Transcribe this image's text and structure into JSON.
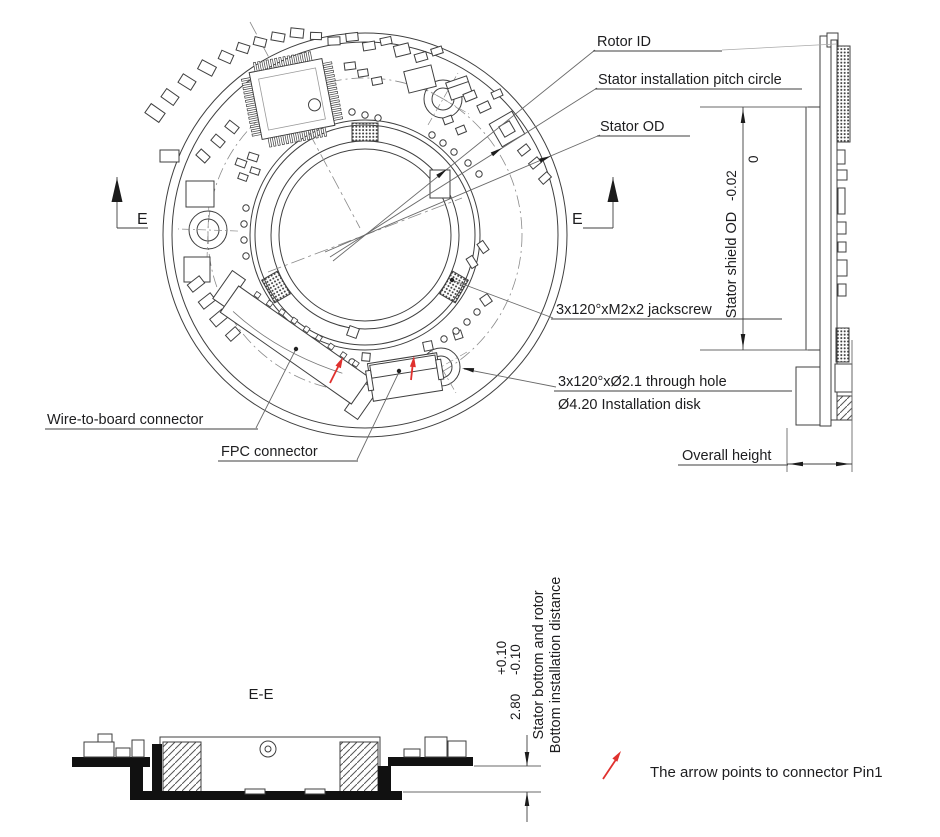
{
  "annotations": {
    "rotor_id": "Rotor ID",
    "pitch_circle": "Stator installation pitch circle",
    "stator_od": "Stator OD",
    "jackscrew": "3x120°xM2x2 jackscrew",
    "through_hole": "3x120°xØ2.1 through hole",
    "installation_disk": "Ø4.20 Installation disk",
    "wire_to_board": "Wire-to-board connector",
    "fpc": "FPC connector",
    "overall_height": "Overall height",
    "section_marker": "E",
    "section_title": "E-E",
    "pin1_note": "The arrow points to connector Pin1"
  },
  "dimensions": {
    "shield_od": {
      "label": "Stator shield OD",
      "tol_upper": "0",
      "tol_lower": "-0.02"
    },
    "bottom_distance": {
      "value": "2.80",
      "tol_upper": "+0.10",
      "tol_lower": "-0.10",
      "note_line1": "Stator bottom and rotor",
      "note_line2": "Bottom installation distance"
    }
  },
  "colors": {
    "line": "#3f3f3f",
    "text": "#1d1d1f",
    "accent_red": "#e0312e"
  }
}
